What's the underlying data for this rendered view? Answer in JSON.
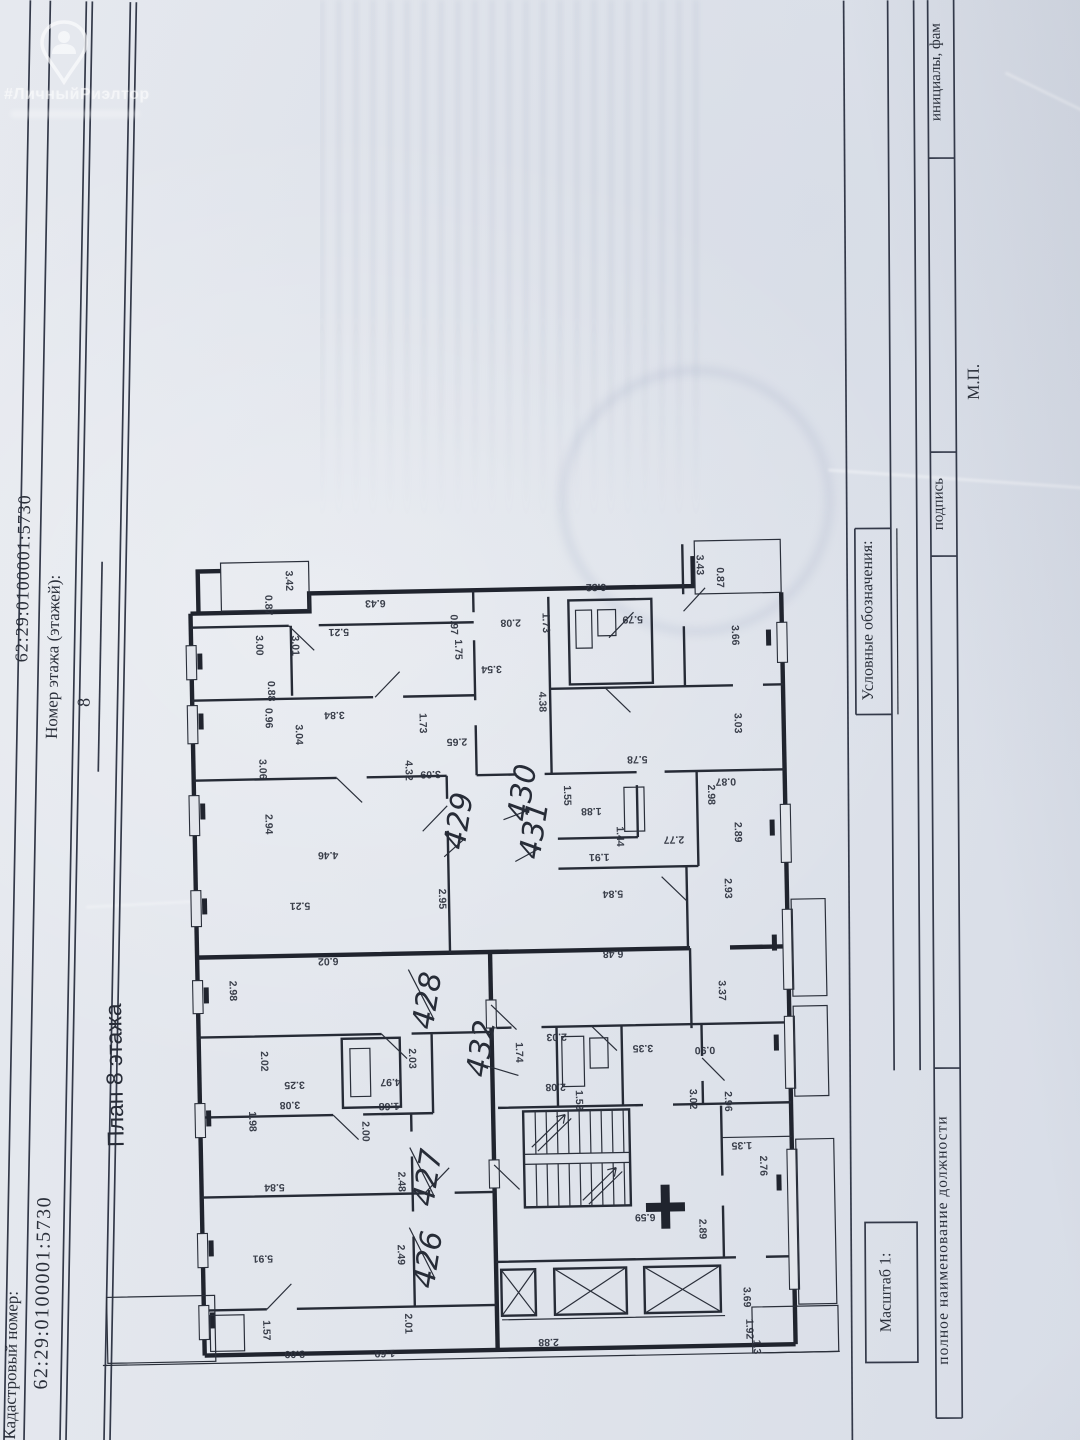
{
  "watermark": {
    "brand": "#ЛичныйРиэлтор"
  },
  "header": {
    "cadastral_label": "Кадастровый номер:",
    "cadastral_value": "62:29:0100001:5730",
    "floor_label": "Номер этажа (этажей):",
    "floor_value": "8"
  },
  "plan": {
    "title": "План 8 этажа",
    "apartments": [
      {
        "n": "426",
        "x": 432,
        "y": 1260,
        "lx": 404,
        "ly": 1226
      },
      {
        "n": "427",
        "x": 433,
        "y": 1178,
        "lx": 406,
        "ly": 1146
      },
      {
        "n": "428",
        "x": 436,
        "y": 1001,
        "lx": 408,
        "ly": 968
      },
      {
        "n": "429",
        "x": 471,
        "y": 822,
        "lx": 446,
        "ly": 856
      },
      {
        "n": "430",
        "x": 535,
        "y": 795,
        "lx": 506,
        "ly": 820
      },
      {
        "n": "431",
        "x": 546,
        "y": 833,
        "lx": 517,
        "ly": 862
      },
      {
        "n": "432",
        "x": 489,
        "y": 1050,
        "lx": 516,
        "ly": 1076
      }
    ],
    "dims": [
      {
        "t": "3.42",
        "x": 293,
        "y": 577,
        "r": 90
      },
      {
        "t": "0.87",
        "x": 272,
        "y": 601,
        "r": 90
      },
      {
        "t": "6.43",
        "x": 382,
        "y": 598,
        "r": 180
      },
      {
        "t": "5.21",
        "x": 345,
        "y": 626,
        "r": 180
      },
      {
        "t": "3.00",
        "x": 262,
        "y": 641,
        "r": 90
      },
      {
        "t": "3.01",
        "x": 298,
        "y": 642,
        "r": 90
      },
      {
        "t": "0.88",
        "x": 273,
        "y": 687,
        "r": 90
      },
      {
        "t": "0.96",
        "x": 270,
        "y": 714,
        "r": 90
      },
      {
        "t": "3.84",
        "x": 339,
        "y": 709,
        "r": 180
      },
      {
        "t": "3.04",
        "x": 300,
        "y": 731,
        "r": 90
      },
      {
        "t": "3.06",
        "x": 263,
        "y": 765,
        "r": 90
      },
      {
        "t": "2.94",
        "x": 268,
        "y": 820,
        "r": 90
      },
      {
        "t": "4.46",
        "x": 330,
        "y": 849,
        "r": 180
      },
      {
        "t": "5.21",
        "x": 301,
        "y": 899,
        "r": 180
      },
      {
        "t": "2.95",
        "x": 440,
        "y": 898,
        "r": 90
      },
      {
        "t": "0.97",
        "x": 457,
        "y": 624,
        "r": 90
      },
      {
        "t": "1.75",
        "x": 461,
        "y": 649,
        "r": 90
      },
      {
        "t": "3.54",
        "x": 497,
        "y": 666,
        "r": 180
      },
      {
        "t": "1.73",
        "x": 424,
        "y": 722,
        "r": 90
      },
      {
        "t": "2.65",
        "x": 461,
        "y": 738,
        "r": 180
      },
      {
        "t": "3.09",
        "x": 434,
        "y": 770,
        "r": 180
      },
      {
        "t": "4.32",
        "x": 409,
        "y": 769,
        "r": 90
      },
      {
        "t": "6.32",
        "x": 603,
        "y": 586,
        "r": 180
      },
      {
        "t": "3.43",
        "x": 704,
        "y": 569,
        "r": 90
      },
      {
        "t": "0.87",
        "x": 724,
        "y": 582,
        "r": 90
      },
      {
        "t": "2.08",
        "x": 517,
        "y": 620,
        "r": 180
      },
      {
        "t": "1.73",
        "x": 549,
        "y": 624,
        "r": 90
      },
      {
        "t": "5.79",
        "x": 639,
        "y": 619,
        "r": 180
      },
      {
        "t": "3.66",
        "x": 738,
        "y": 640,
        "r": 90
      },
      {
        "t": "4.38",
        "x": 544,
        "y": 703,
        "r": 90
      },
      {
        "t": "3.03",
        "x": 739,
        "y": 728,
        "r": 90
      },
      {
        "t": "5.78",
        "x": 641,
        "y": 759,
        "r": 180
      },
      {
        "t": "0.87",
        "x": 729,
        "y": 783,
        "r": 180
      },
      {
        "t": "2.98",
        "x": 711,
        "y": 799,
        "r": 90
      },
      {
        "t": "1.55",
        "x": 567,
        "y": 797,
        "r": 90
      },
      {
        "t": "1.88",
        "x": 594,
        "y": 810,
        "r": 180
      },
      {
        "t": "1.44",
        "x": 619,
        "y": 839,
        "r": 90
      },
      {
        "t": "2.77",
        "x": 676,
        "y": 840,
        "r": 180
      },
      {
        "t": "2.89",
        "x": 737,
        "y": 837,
        "r": 90
      },
      {
        "t": "1.91",
        "x": 601,
        "y": 856,
        "r": 180
      },
      {
        "t": "5.84",
        "x": 614,
        "y": 893,
        "r": 180
      },
      {
        "t": "2.93",
        "x": 726,
        "y": 893,
        "r": 90
      },
      {
        "t": "6.48",
        "x": 613,
        "y": 953,
        "r": 180
      },
      {
        "t": "6.02",
        "x": 328,
        "y": 955,
        "r": 180
      },
      {
        "t": "2.98",
        "x": 229,
        "y": 986,
        "r": 90
      },
      {
        "t": "2.02",
        "x": 259,
        "y": 1057,
        "r": 90
      },
      {
        "t": "3.25",
        "x": 292,
        "y": 1078,
        "r": 180
      },
      {
        "t": "2.03",
        "x": 407,
        "y": 1057,
        "r": 90
      },
      {
        "t": "4.97",
        "x": 388,
        "y": 1077,
        "r": 180
      },
      {
        "t": "3.08",
        "x": 287,
        "y": 1098,
        "r": 180
      },
      {
        "t": "1.68",
        "x": 386,
        "y": 1101,
        "r": 180
      },
      {
        "t": "1.98",
        "x": 246,
        "y": 1117,
        "r": 90
      },
      {
        "t": "2.00",
        "x": 359,
        "y": 1129,
        "r": 90
      },
      {
        "t": "5.84",
        "x": 270,
        "y": 1180,
        "r": 180
      },
      {
        "t": "2.48",
        "x": 394,
        "y": 1180,
        "r": 90
      },
      {
        "t": "5.91",
        "x": 257,
        "y": 1251,
        "r": 180
      },
      {
        "t": "2.49",
        "x": 392,
        "y": 1253,
        "r": 90
      },
      {
        "t": "1.57",
        "x": 256,
        "y": 1326,
        "r": 90
      },
      {
        "t": "3.09",
        "x": 287,
        "y": 1347,
        "r": 180
      },
      {
        "t": "2.01",
        "x": 398,
        "y": 1322,
        "r": 90
      },
      {
        "t": "1.69",
        "x": 377,
        "y": 1348,
        "r": 180
      },
      {
        "t": "3.37",
        "x": 718,
        "y": 995,
        "r": 90
      },
      {
        "t": "2.03",
        "x": 555,
        "y": 1035,
        "r": 180
      },
      {
        "t": "1.74",
        "x": 514,
        "y": 1053,
        "r": 90
      },
      {
        "t": "3.35",
        "x": 641,
        "y": 1048,
        "r": 180
      },
      {
        "t": "0.90",
        "x": 703,
        "y": 1051,
        "r": 180
      },
      {
        "t": "2.08",
        "x": 553,
        "y": 1085,
        "r": 180
      },
      {
        "t": "1.53",
        "x": 573,
        "y": 1102,
        "r": 90
      },
      {
        "t": "3.02",
        "x": 687,
        "y": 1103,
        "r": 90
      },
      {
        "t": "2.96",
        "x": 722,
        "y": 1106,
        "r": 90
      },
      {
        "t": "1.35",
        "x": 738,
        "y": 1147,
        "r": 180
      },
      {
        "t": "2.76",
        "x": 756,
        "y": 1171,
        "r": 90
      },
      {
        "t": "6.59",
        "x": 640,
        "y": 1217,
        "r": 180
      },
      {
        "t": "2.89",
        "x": 694,
        "y": 1233,
        "r": 90
      },
      {
        "t": "3.69",
        "x": 737,
        "y": 1302,
        "r": 90
      },
      {
        "t": "1.92",
        "x": 739,
        "y": 1334,
        "r": 90
      },
      {
        "t": "1.3",
        "x": 746,
        "y": 1352,
        "r": 90
      },
      {
        "t": "2.88",
        "x": 541,
        "y": 1340,
        "r": 180
      }
    ]
  },
  "footer": {
    "scale_label": "Масштаб 1:",
    "legend_label": "Условные обозначения:",
    "position_label": "полное наименование должности",
    "signature_label": "подпись",
    "initials_label": "инициалы, фам",
    "stamp_label": "М.П."
  }
}
